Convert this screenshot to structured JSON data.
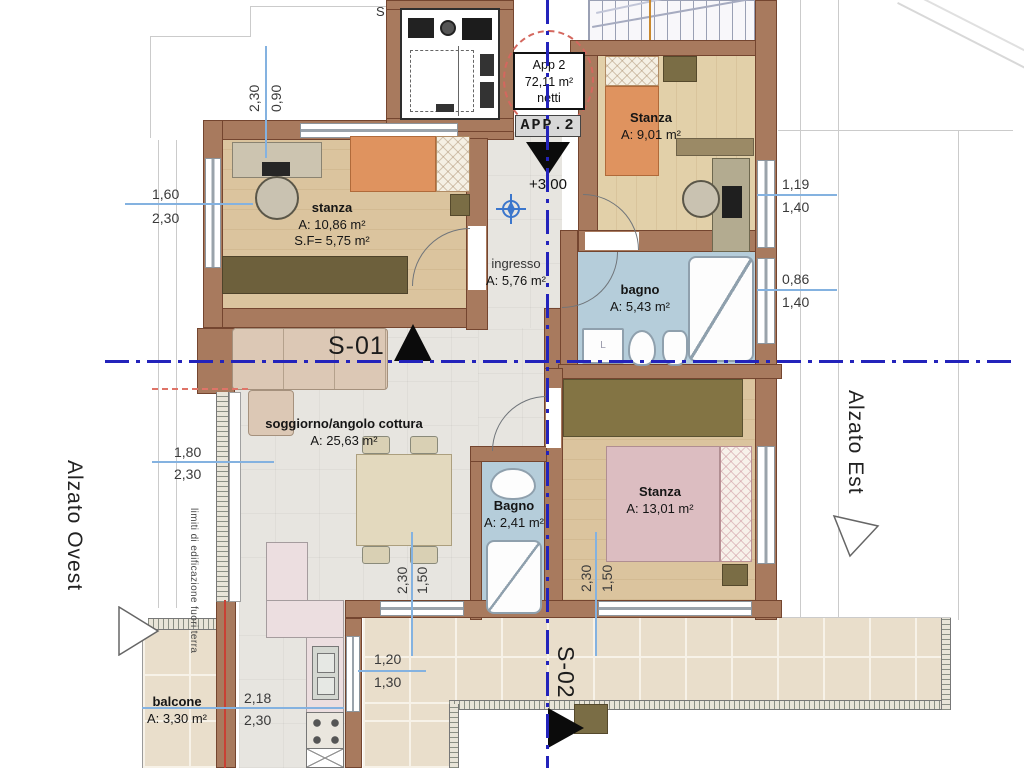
{
  "header": {
    "app_box": {
      "l1": "App 2",
      "l2": "72,11 m²",
      "l3": "netti"
    },
    "app_tag": "APP.2",
    "level": "+3,00",
    "s_mark": "S"
  },
  "rooms": {
    "stanza_nw": {
      "name": "stanza",
      "area": "A: 10,86 m²",
      "extra": "S.F= 5,75 m²"
    },
    "stanza_ne": {
      "name": "Stanza",
      "area": "A: 9,01 m²"
    },
    "ingresso": {
      "name": "ingresso",
      "area": "A: 5,76 m²"
    },
    "bagno_grande": {
      "name": "bagno",
      "area": "A: 5,43 m²"
    },
    "soggiorno": {
      "name": "soggiorno/angolo cottura",
      "area": "A: 25,63 m²"
    },
    "bagno_piccolo": {
      "name": "Bagno",
      "area": "A: 2,41 m²"
    },
    "stanza_se": {
      "name": "Stanza",
      "area": "A: 13,01 m²"
    },
    "balcone": {
      "name": "balcone",
      "area": "A: 3,30 m²"
    }
  },
  "sections": {
    "s01": "S-01",
    "s02": "S-02"
  },
  "elevations": {
    "west": "Alzato Ovest",
    "east": "Alzato Est"
  },
  "notes": {
    "boundary": "limiti di edificazione fuori terra"
  },
  "washer_label": "L",
  "dimensions": {
    "win_nw": {
      "w": "1,60",
      "h": "2,30"
    },
    "win_top": {
      "w": "0,90",
      "h": "2,30"
    },
    "win_ne_upper": {
      "w": "1,19",
      "h": "1,40"
    },
    "win_ne_lower": {
      "w": "0,86",
      "h": "1,40"
    },
    "win_w": {
      "w": "1,80",
      "h": "2,30"
    },
    "win_living": {
      "w": "1,50",
      "h": "2,30"
    },
    "win_se": {
      "w": "1,50",
      "h": "2,30"
    },
    "win_balcone": {
      "w": "2,18",
      "h": "2,30"
    },
    "win_terrace": {
      "w": "1,20",
      "h": "1,30"
    }
  },
  "colors": {
    "centerline": "#2323bb",
    "dimension": "#84b2e0",
    "wall": "#a87a5e",
    "accent_red": "#d4675e"
  }
}
